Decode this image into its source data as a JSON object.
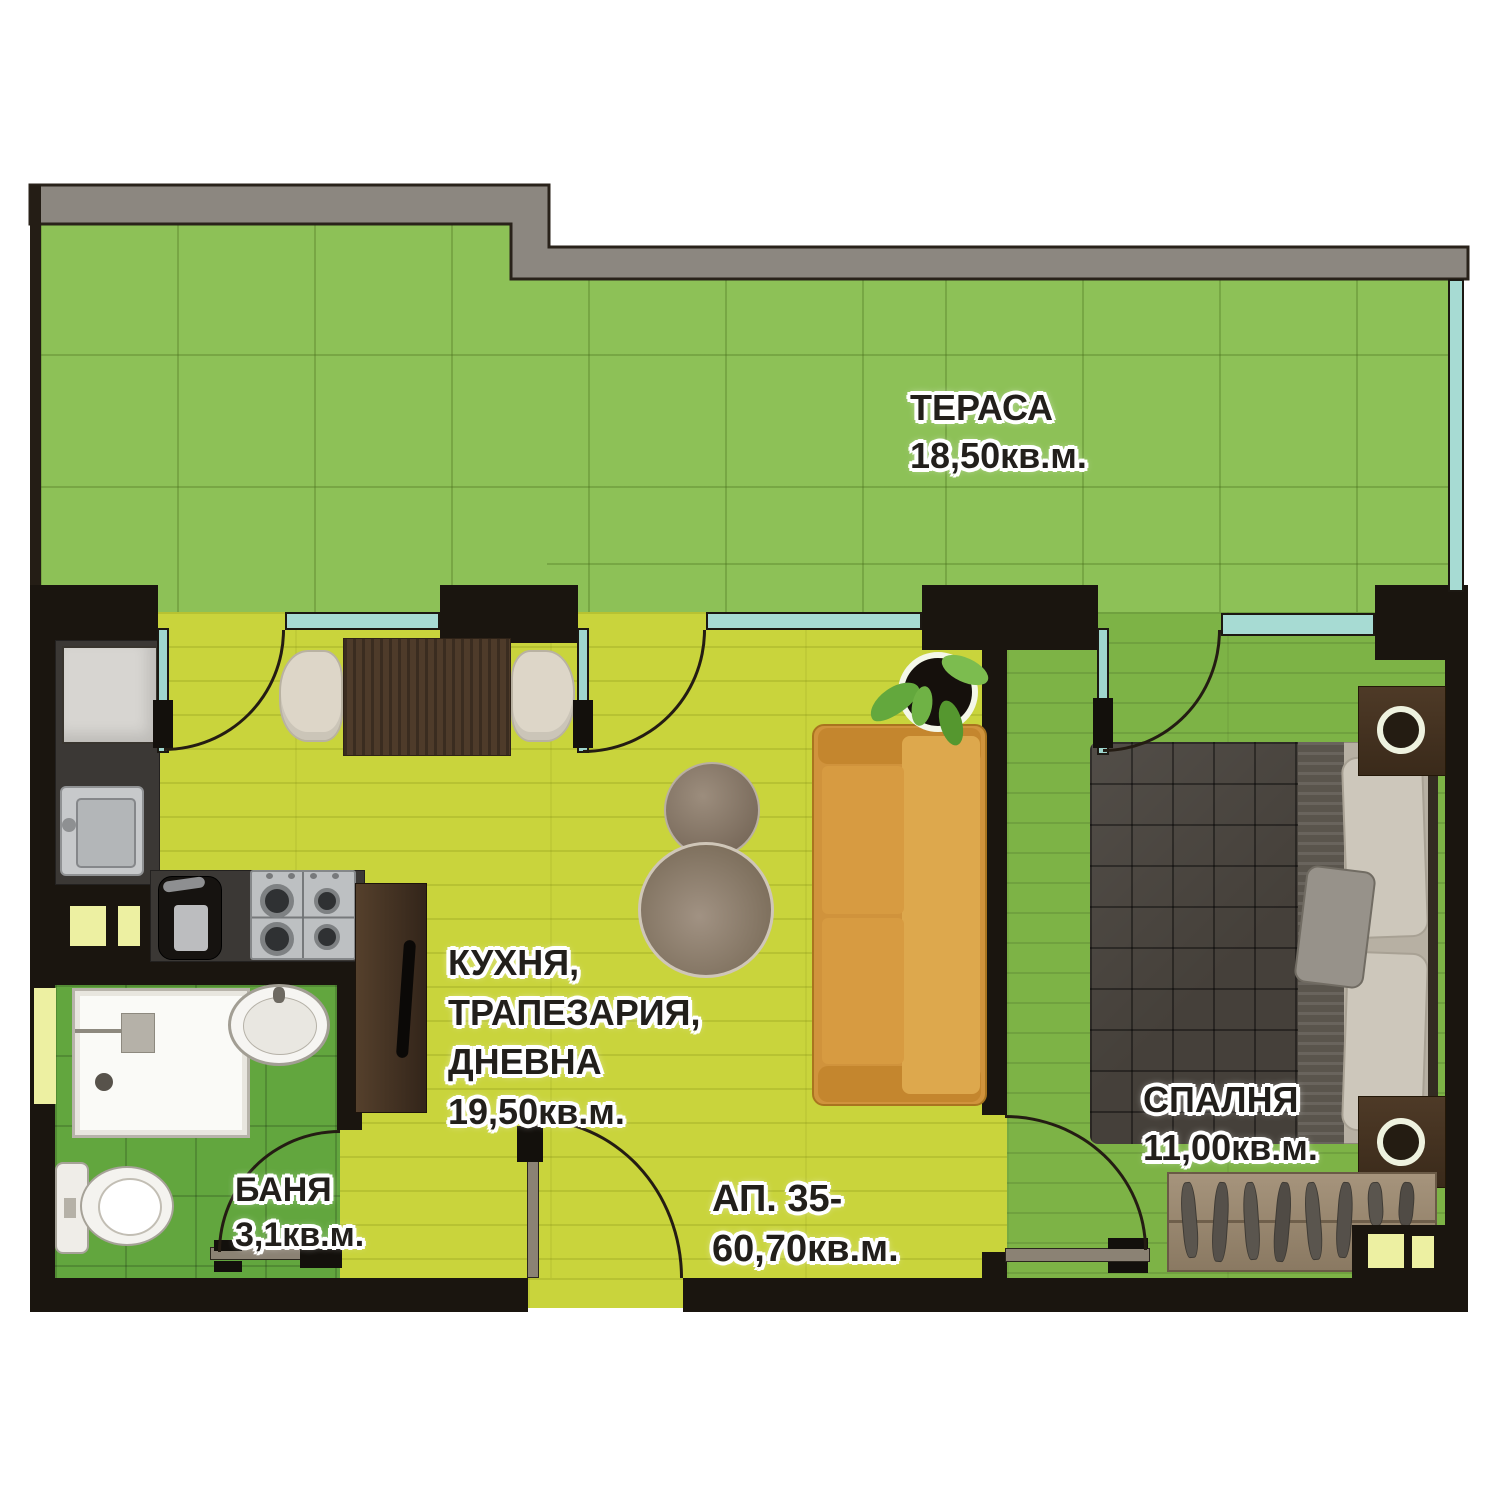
{
  "plan": {
    "type": "apartment-floor-plan",
    "apartment": {
      "number_label": "АП. 35-",
      "total_area": "60,70кв.м."
    },
    "rooms": {
      "terrace": {
        "name": "ТЕРАСА",
        "area": "18,50кв.м."
      },
      "kitchen_living": {
        "line1": "КУХНЯ,",
        "line2": "ТРАПЕЗАРИЯ,",
        "line3": "ДНЕВНА",
        "area": "19,50кв.м."
      },
      "bathroom": {
        "name": "БАНЯ",
        "area": "3,1кв.м."
      },
      "bedroom": {
        "name": "СПАЛНЯ",
        "area": "11,00кв.м."
      }
    },
    "furniture": [
      "dining-table",
      "dining-chairs",
      "sofa",
      "coffee-tables",
      "potted-plant",
      "fridge",
      "kitchen-sink",
      "coffee-machine",
      "gas-stove",
      "tall-cabinet",
      "shower",
      "washbasin",
      "toilet",
      "double-bed",
      "nightstands-with-lamps",
      "open-wardrobe-with-hangers"
    ],
    "colors": {
      "wall": "#1a150f",
      "parapet_gray": "#8c8780",
      "terrace_green": "#8dc157",
      "living_yellow_green": "#c9d43c",
      "bedroom_green": "#7db346",
      "bathroom_green": "#62a63e",
      "window_teal": "#a7dbd3",
      "sofa_orange": "#d0933c",
      "counter_dark": "#3b3835",
      "wood_dark": "#4e3b2a",
      "label_text": "#221f1b"
    }
  }
}
